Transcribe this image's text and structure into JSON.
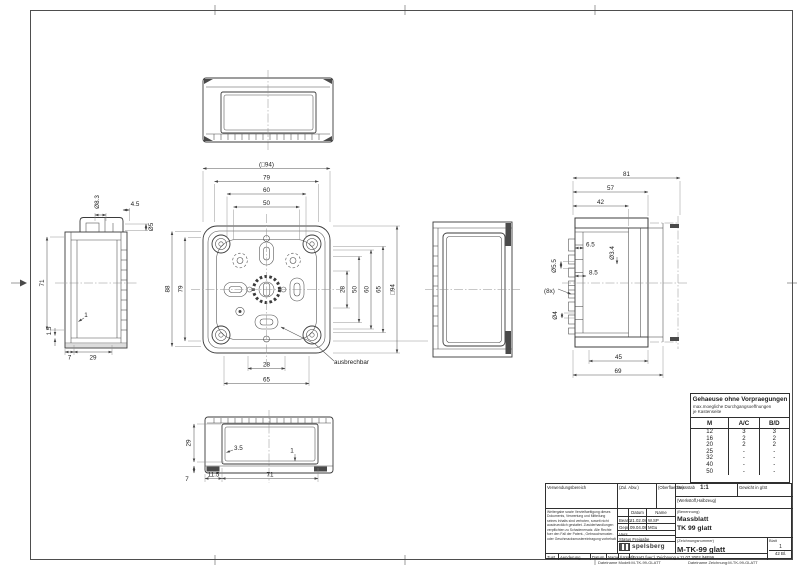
{
  "views": {
    "front": {
      "dim_outer_top": "(□94)",
      "dim_79_top": "79",
      "dim_60_top": "60",
      "dim_50_top": "50",
      "dim_88_left": "88",
      "dim_79_left": "79",
      "dim_28_right": "28",
      "dim_50_right": "50",
      "dim_60_right": "60",
      "dim_65_right": "65",
      "dim_outer_right": "□94",
      "dim_28_bottom": "28",
      "dim_65_bottom": "65",
      "note_ausbrechbar": "ausbrechbar"
    },
    "left_side": {
      "dim_dia_8_3": "Ø8.3",
      "dim_4_5": "4.5",
      "dim_dia_5": "Ø5",
      "dim_71": "71",
      "dim_1_5": "1.5",
      "dim_1": "1",
      "dim_7": "7",
      "dim_29": "29"
    },
    "section": {
      "dim_81": "81",
      "dim_57": "57",
      "dim_42": "42",
      "dim_6_5": "6.5",
      "dim_dia_3_4": "Ø3.4",
      "dim_dia_5_5": "Ø5.5",
      "dim_8_5": "8.5",
      "dim_8x": "(8x)",
      "dim_dia_4": "Ø4",
      "dim_45": "45",
      "dim_69": "69"
    },
    "bottom": {
      "dim_29": "29",
      "dim_3_5": "3.5",
      "dim_1": "1",
      "dim_7": "7",
      "dim_11_5": "11.5",
      "dim_71": "71"
    }
  },
  "knockout_table": {
    "title": "Gehaeuse ohne Vorpraegungen",
    "subtitle_line1": "max.moegliche Durchgangsoeffnungen",
    "subtitle_line2": "je Kastenseite",
    "col_m": "M",
    "col_ac": "A/C",
    "col_bd": "B/D",
    "rows": [
      {
        "m": "12",
        "ac": "3",
        "bd": "3"
      },
      {
        "m": "16",
        "ac": "2",
        "bd": "2"
      },
      {
        "m": "20",
        "ac": "2",
        "bd": "2"
      },
      {
        "m": "25",
        "ac": "-",
        "bd": "-"
      },
      {
        "m": "32",
        "ac": "-",
        "bd": "-"
      },
      {
        "m": "40",
        "ac": "-",
        "bd": "-"
      },
      {
        "m": "50",
        "ac": "-",
        "bd": "-"
      }
    ]
  },
  "title_block": {
    "verwendungsbereich_label": "Verwendungsbereich",
    "zul_abw_label": "(Zul. Abw.)",
    "oberflaeche_label": "(Oberflaeche)",
    "massstab_label": "Massstab",
    "massstab_value": "1:1",
    "gewicht_label": "Gewicht in g/St",
    "werkstoff_label": "(Werkstoff,Halbzeug)",
    "legal_lines": [
      "Weitergabe sowie Vervielfaeltigung dieses",
      "Dokuments, Verwertung und Mitteilung",
      "seines Inhalts sind verboten, soweit nicht",
      "ausdruecklich gestattet. Zuwiderhandlungen",
      "verpflichten zu Schadenersatz. Alle Rechte",
      "fuer den Fall der Patent-, Gebrauchsmuster-",
      "oder Geschmacksmustereintragung vorbehalten."
    ],
    "datum_col_label": "Datum",
    "name_col_label": "Name",
    "bearb_label": "Bearb.",
    "bearb_date": "21.02.08",
    "bearb_name": "W.SP",
    "gepr_label": "Gepr.",
    "gepr_date": "09.04.08",
    "gepr_name": "MGu",
    "vers_label": "Vers.",
    "status_label": "Status",
    "status_value": "Freigabe",
    "logo_text": "spelsberg",
    "benennung_label": "(Benennung)",
    "benennung_line1": "Massblatt",
    "benennung_line2": "TK 99 glatt",
    "zeichnungsnummer_label": "(Zeichnungsnummer)",
    "zeichnungsnummer_value": "M-TK-99 glatt",
    "blatt_label": "Blatt",
    "blatt_value": "1",
    "blatt_total": "42 Bl.",
    "zust_label": "Zust.",
    "aenderung_label": "Aenderung",
    "datum2_label": "Datum",
    "name2_label": "Name",
    "urspr_label": "(Urspr.)",
    "ersatz_text": "(Ersatz fuer:) Zeichnung v.11.07.2002 /ME99",
    "file_model": "Dateiname Modell:M-TK-99-GLATT",
    "file_drawing": "Dateiname Zeichnung:M-TK-99-GLATT"
  }
}
